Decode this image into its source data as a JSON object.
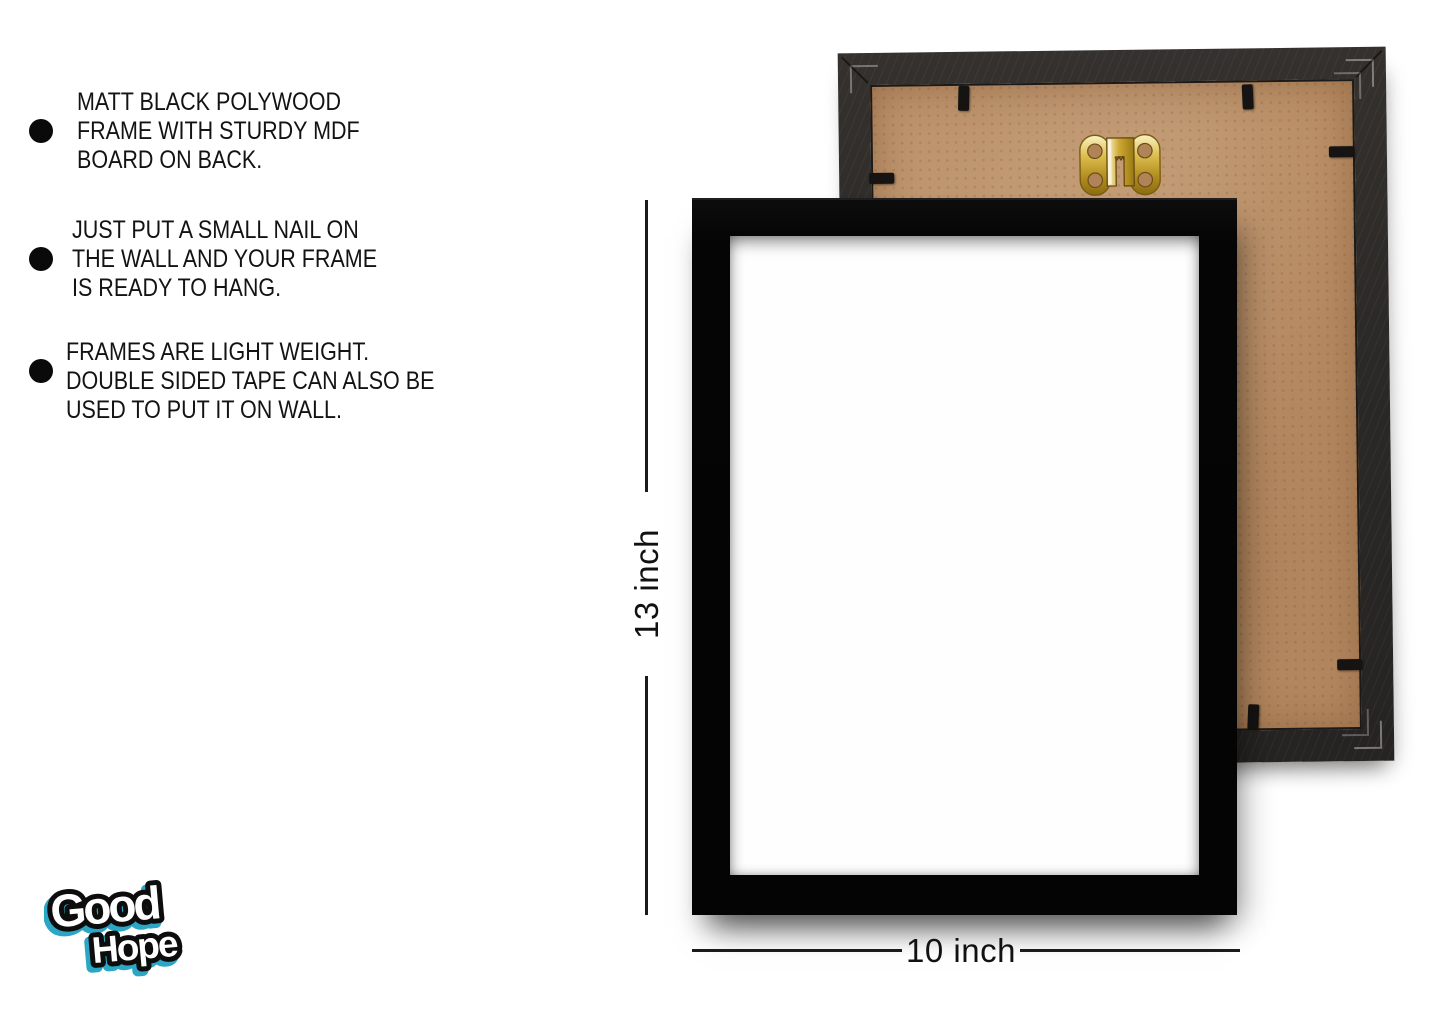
{
  "features": [
    {
      "text": "MATT BLACK POLYWOOD\nFRAME WITH STURDY MDF\nBOARD ON BACK."
    },
    {
      "text": "JUST PUT A SMALL NAIL ON\nTHE WALL AND YOUR FRAME\nIS READY TO HANG."
    },
    {
      "text": "FRAMES ARE LIGHT WEIGHT.\nDOUBLE SIDED TAPE CAN ALSO BE\nUSED TO PUT IT ON WALL."
    }
  ],
  "dimensions": {
    "height_label": "13 inch",
    "width_label": "10 inch"
  },
  "logo": {
    "word1": "Good",
    "word2": "Hope"
  },
  "colors": {
    "background": "#ffffff",
    "front_frame_black": "#060606",
    "back_frame_dark": "#2c2a28",
    "mdf_board_tan": "#b98e66",
    "hanger_gold": "#c9a22f",
    "logo_teal": "#2ba6c4",
    "dimension_line": "#1a1a1a",
    "text_black": "#131313"
  }
}
